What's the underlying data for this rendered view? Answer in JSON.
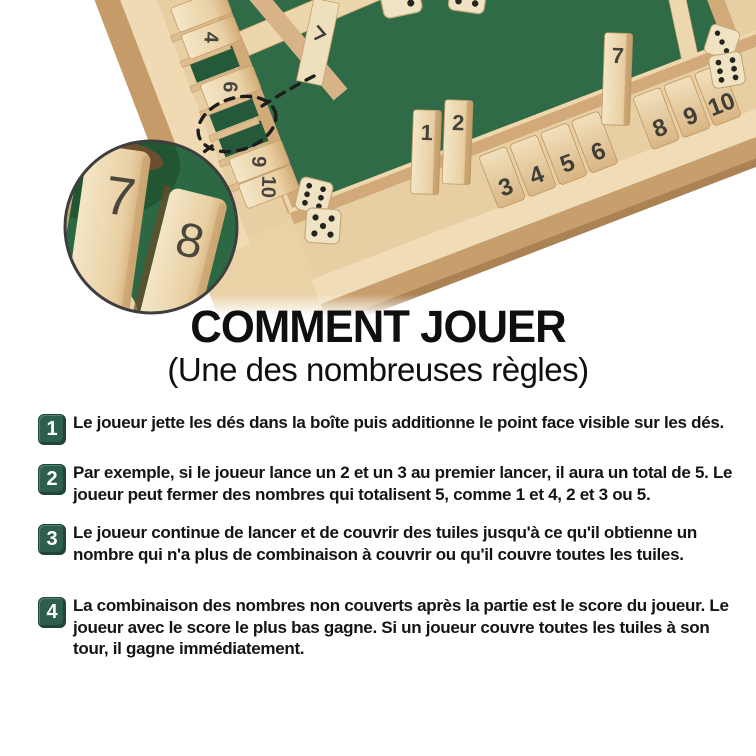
{
  "header": {
    "title": "COMMENT JOUER",
    "subtitle": "(Une des nombreuses règles)"
  },
  "steps": [
    {
      "num": "1",
      "text": "Le joueur jette les dés dans la boîte puis additionne le point face visible sur les dés."
    },
    {
      "num": "2",
      "text": "Par exemple, si le joueur lance un 2 et un 3 au premier lancer, il aura un total de 5. Le joueur peut fermer des nombres qui totalisent 5, comme 1 et 4, 2 et 3 ou 5."
    },
    {
      "num": "3",
      "text": "Le joueur continue de lancer et de couvrir des tuiles jusqu'à ce qu'il obtienne un nombre qui n'a plus de combinaison à couvrir ou qu'il couvre toutes les tuiles."
    },
    {
      "num": "4",
      "text": "La combinaison des nombres non couverts après la partie est le score du joueur. Le joueur avec le score le plus bas gagne. Si un joueur couvre toutes les tuiles à son tour, il gagne immédiatement."
    }
  ],
  "photo": {
    "front_row_tiles": [
      "1",
      "2",
      "3",
      "4",
      "5",
      "6",
      "7",
      "8",
      "9",
      "10"
    ],
    "left_row_tiles": [
      "4",
      "6",
      "9",
      "10"
    ],
    "inset_tiles": [
      "7",
      "8"
    ]
  },
  "colors": {
    "felt_green": "#2e6b46",
    "badge_green": "#2c5f4e",
    "wood_light": "#eed9b2",
    "text_black": "#141414"
  }
}
